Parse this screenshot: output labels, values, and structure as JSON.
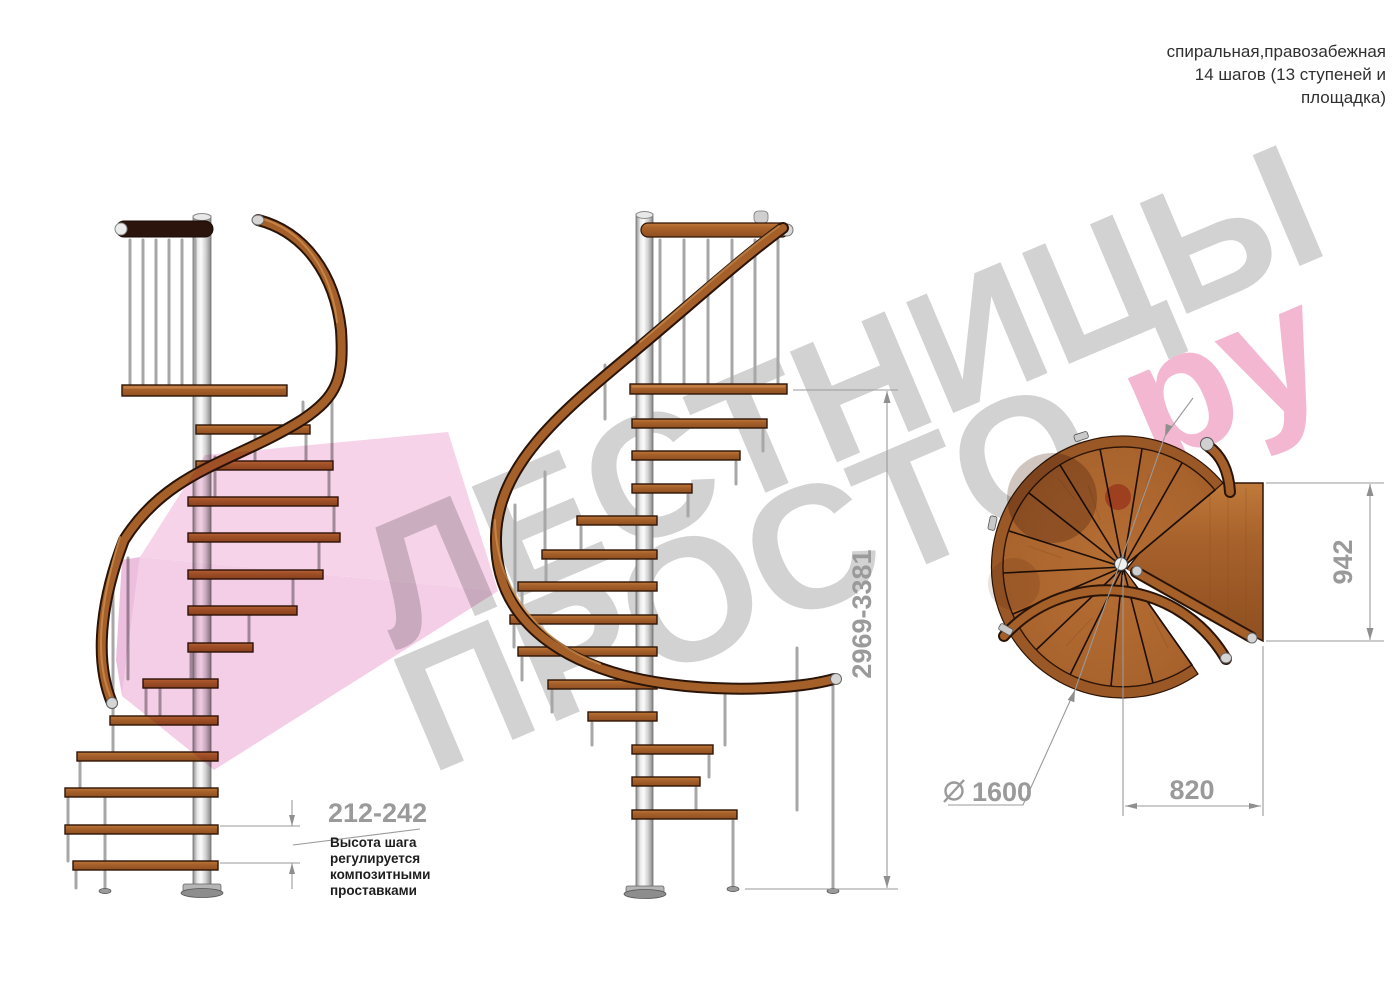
{
  "header": {
    "line1": "спиральная,правозабежная",
    "line2": "14 шагов (13 ступеней и",
    "line3": "площадка)"
  },
  "watermark": {
    "line1": "ЛЕСТНИЦЫ",
    "line2_gray": "ПРОСТО",
    "line2_pink": ".ру",
    "gray_color": "#d2d2d2",
    "pink_color": "#f3b7d2"
  },
  "dims": {
    "step_height": "212-242",
    "total_height": "2969-3381",
    "landing_depth": "942",
    "landing_width": "820",
    "diameter": "1600"
  },
  "note": {
    "line1": "Высота шага",
    "line2": "регулируется",
    "line3": "композитными",
    "line4": "проставками"
  },
  "colors": {
    "wood": "#a8622c",
    "wood_dark": "#2e1507",
    "metal_pole": "#d9d9d9",
    "logo_pink": "#f2c4e2",
    "dim_gray": "#9a9a9a"
  }
}
